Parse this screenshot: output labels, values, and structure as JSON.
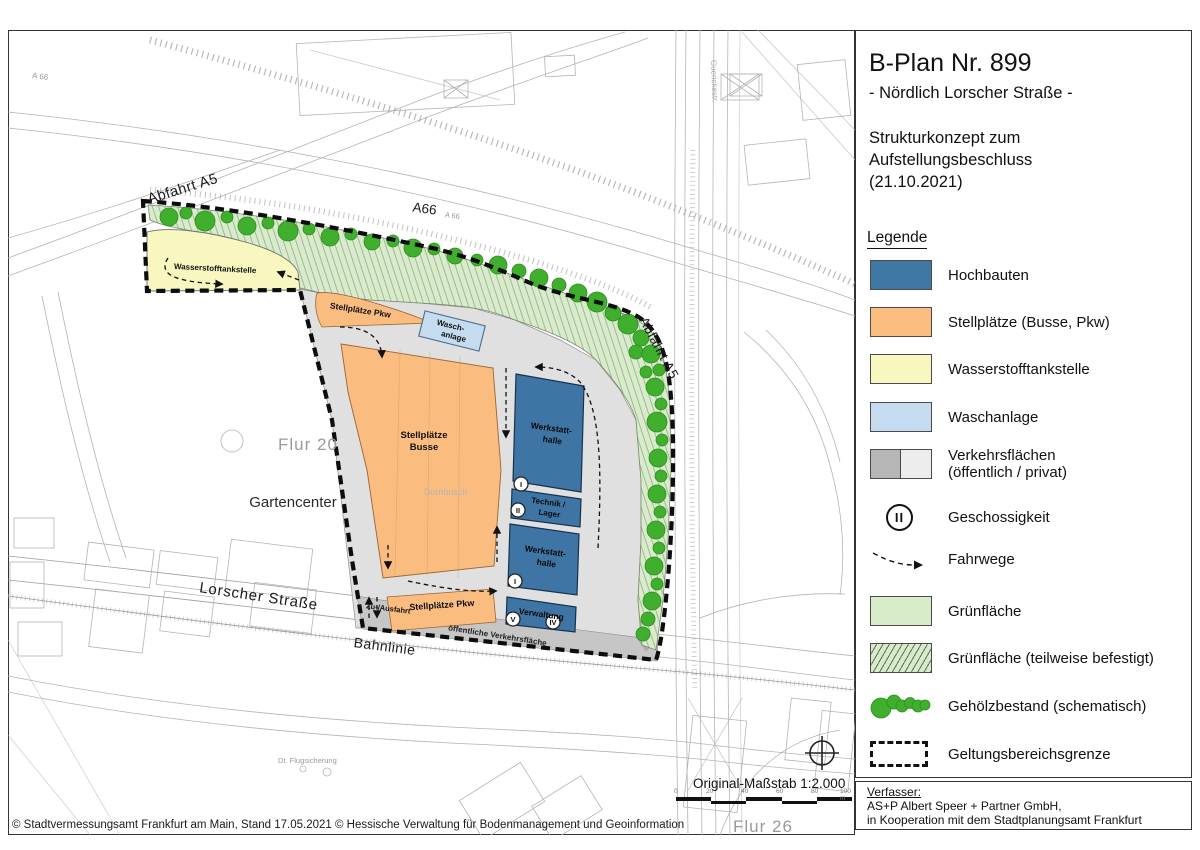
{
  "title_block": {
    "title": "B-Plan Nr. 899",
    "subtitle": "- Nördlich Lorscher Straße -",
    "description_line1": "Strukturkonzept zum",
    "description_line2": "Aufstellungsbeschluss",
    "description_line3": "(21.10.2021)"
  },
  "legend": {
    "heading": "Legende",
    "items": [
      {
        "label": "Hochbauten",
        "color": "#4078A4"
      },
      {
        "label": "Stellplätze (Busse, Pkw)",
        "color": "#FBBC80"
      },
      {
        "label": "Wasserstofftankstelle",
        "color": "#F8F7C0"
      },
      {
        "label": "Waschanlage",
        "color": "#C5DCF0"
      },
      {
        "label": "Verkehrsflächen",
        "label2": "(öffentlich / privat)",
        "color": "#B7B7B7",
        "color2": "#EDEDED"
      },
      {
        "label": "Geschossigkeit",
        "glyph": "II"
      },
      {
        "label": "Fahrwege"
      },
      {
        "label": "Grünfläche",
        "color": "#D8ECCA"
      },
      {
        "label": "Grünfläche (teilweise befestigt)",
        "color": "#D8ECCA"
      },
      {
        "label": "Gehölzbestand (schematisch)",
        "color": "#3FAF2D"
      },
      {
        "label": "Geltungsbereichsgrenze"
      }
    ]
  },
  "author_block": {
    "heading": "Verfasser:",
    "line1": "AS+P Albert Speer + Partner GmbH,",
    "line2": "in Kooperation mit dem Stadtplanungsamt Frankfurt"
  },
  "scale": {
    "label": "Original-Maßstab 1:2.000",
    "ticks": [
      "0",
      "20",
      "40",
      "60",
      "80",
      "100 m"
    ]
  },
  "footer": {
    "copyright": "© Stadtvermessungsamt Frankfurt am Main, Stand 17.05.2021 © Hessische Verwaltung für Bodenmanagement und Geoinformation"
  },
  "map": {
    "labels": {
      "abfahrt_a5_left": "Abfahrt A5",
      "a66": "A66",
      "a66_small": "A 66",
      "a66_far": "A 66",
      "abfahrt_a5_right": "Abfahrt A5",
      "guericke": "Guerickestr.",
      "lorscher": "Lorscher Straße",
      "bahnlinie": "Bahnlinie",
      "flur20": "Flur 20",
      "flur26": "Flur 26",
      "gartencenter": "Gartencenter",
      "dornbusch": "Dornbusch",
      "flugsicherung": "Dt. Flugsicherung",
      "wasserstoff": "Wasserstofftankstelle",
      "stellplaetze_pkw_top": "Stellplätze Pkw",
      "wasch1": "Wasch-",
      "wasch2": "anlage",
      "busse1": "Stellplätze",
      "busse2": "Busse",
      "werkstatt1a": "Werkstatt-",
      "werkstatt1b": "halle",
      "technik1": "Technik /",
      "technik2": "Lager",
      "werkstatt2a": "Werkstatt-",
      "werkstatt2b": "halle",
      "verwaltung": "Verwaltung",
      "stellplaetze_pkw_bottom": "Stellplätze Pkw",
      "zufahrt": "Zu-/Ausfahrt",
      "oeffentliche": "öffentliche Verkehrsfläche"
    },
    "floors": {
      "f1": "I",
      "f2": "II",
      "f3": "I",
      "f4": "V",
      "f5": "IV"
    }
  },
  "colors": {
    "hochbauten": "#4078A4",
    "stellplaetze": "#FBBC80",
    "wasserstoff": "#F8F7C0",
    "waschanlage": "#C5DCF0",
    "verkehr_oeffentlich": "#B7B7B7",
    "verkehr_privat": "#EDEDED",
    "gruenflaeche": "#D8ECCA",
    "gehoelz": "#3FAF2D",
    "grenze": "#111111"
  }
}
